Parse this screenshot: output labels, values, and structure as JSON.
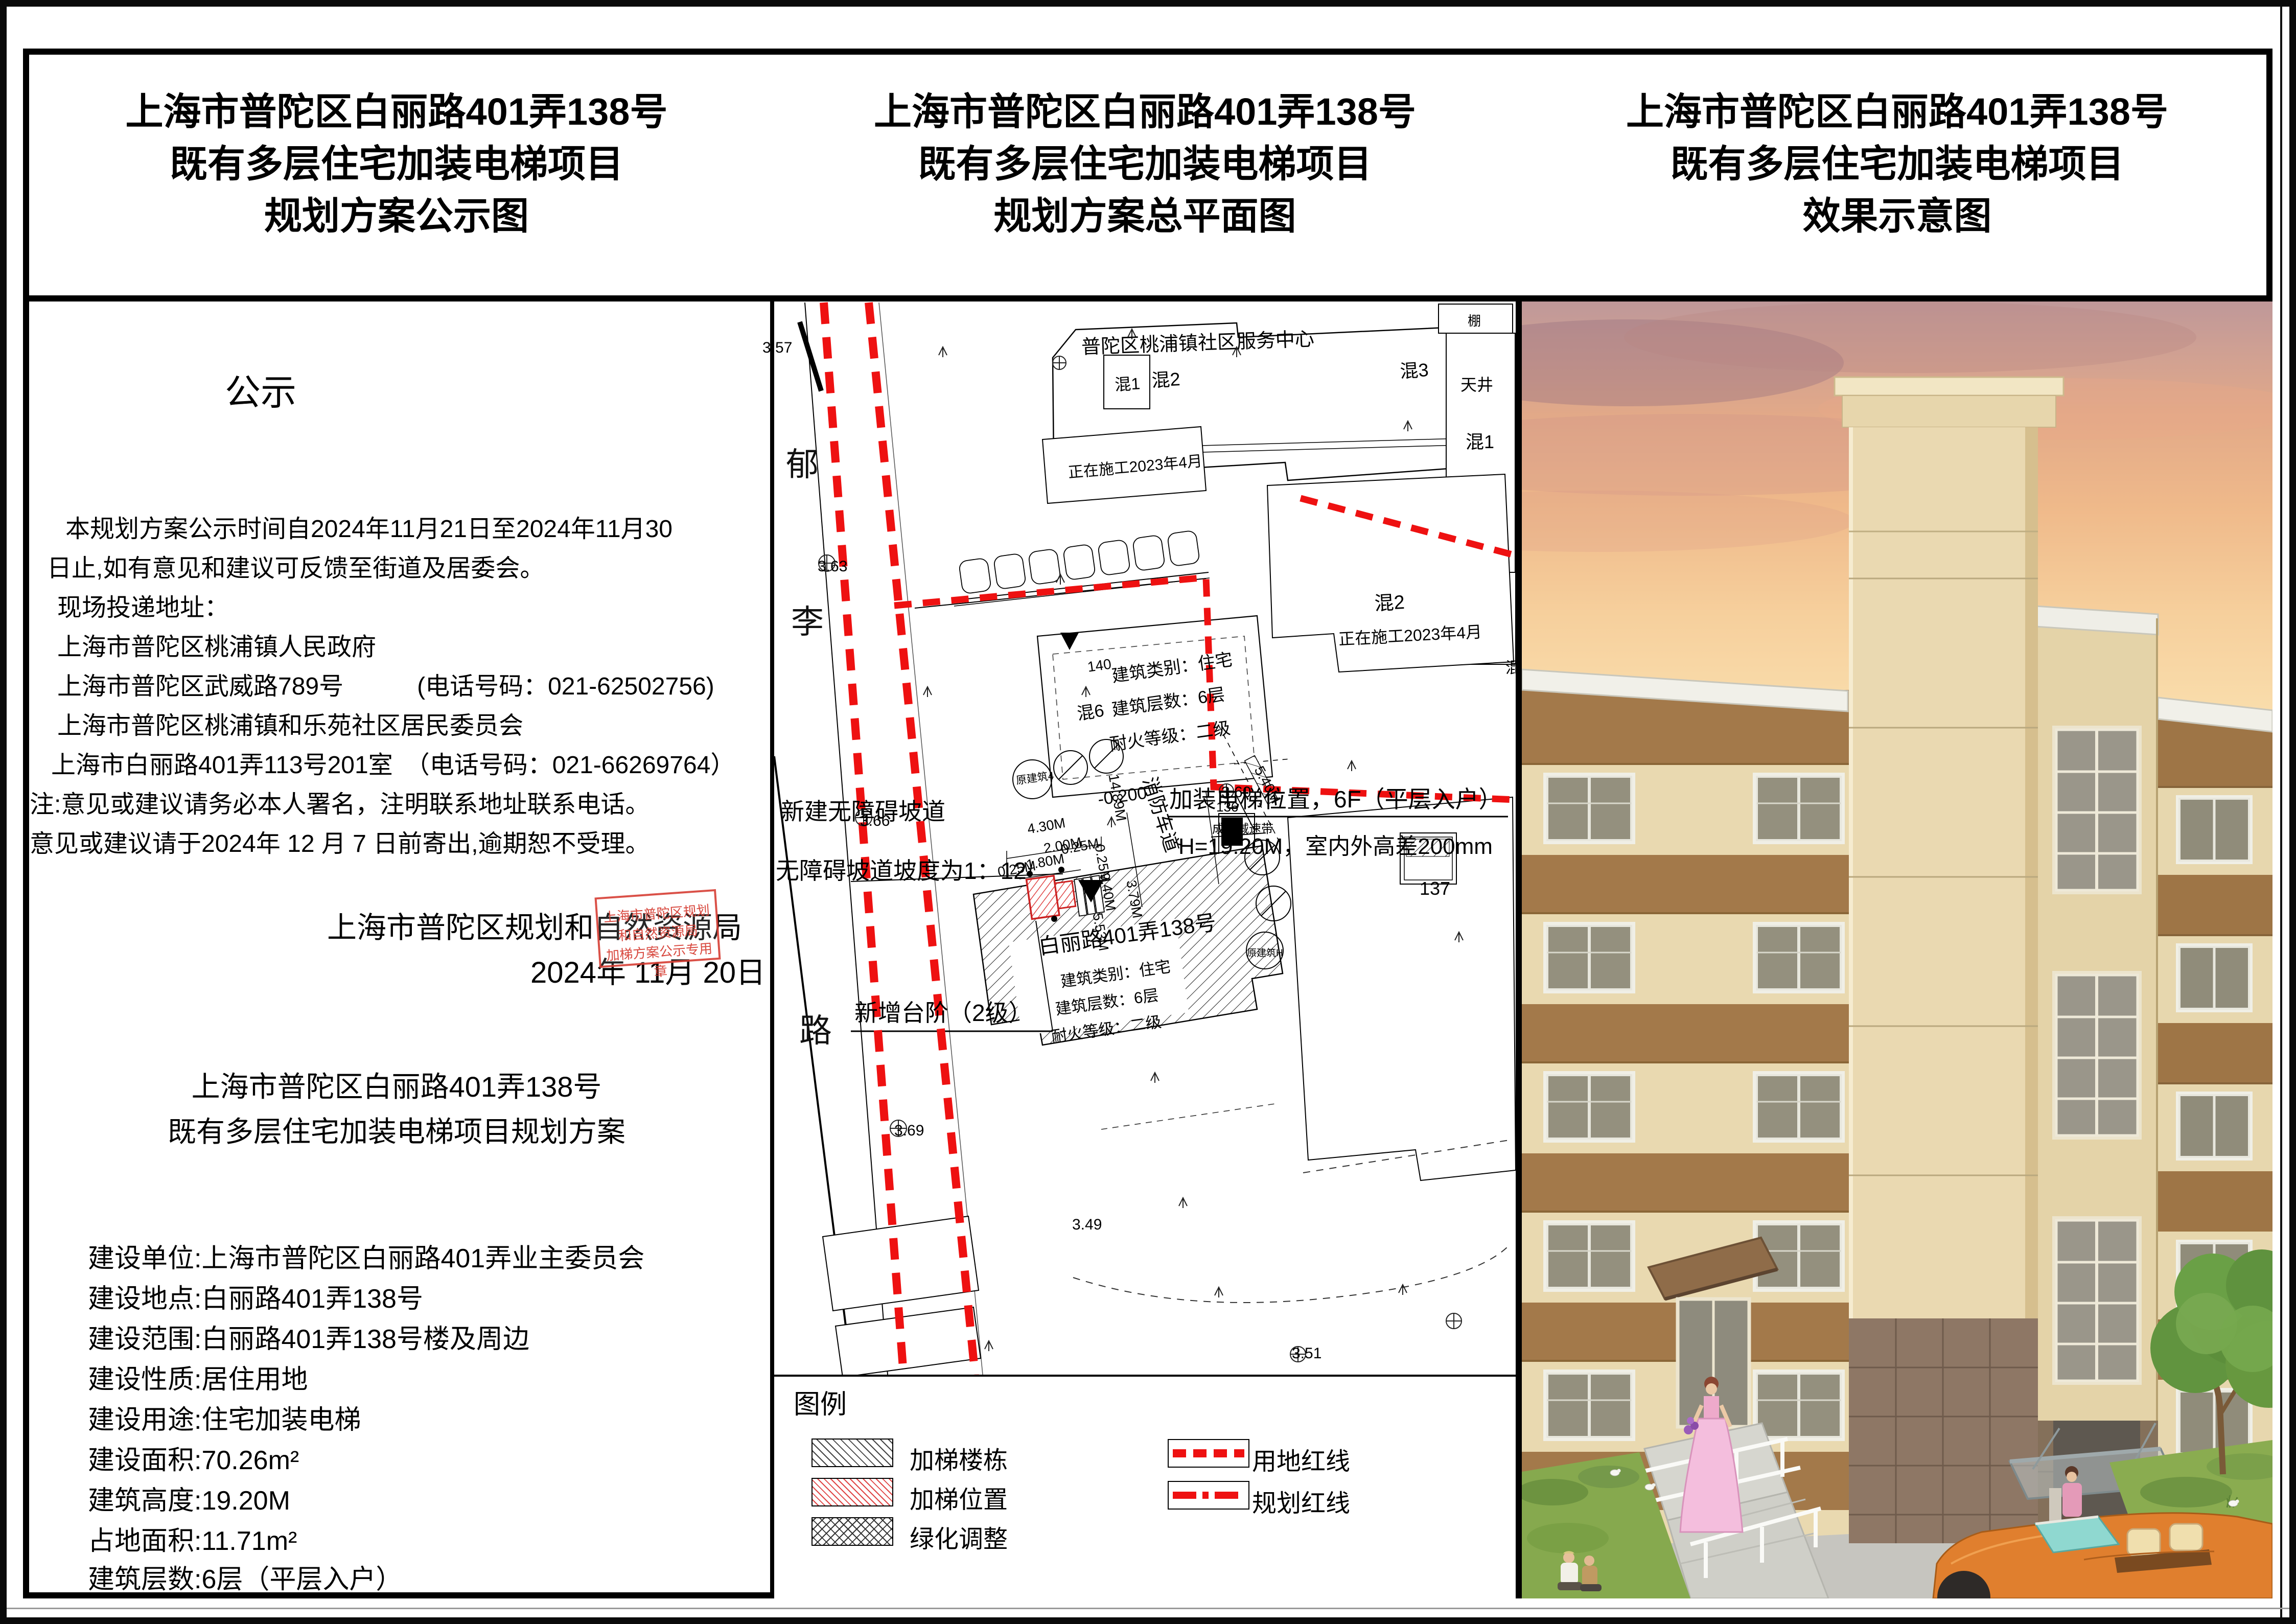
{
  "header": {
    "col1": [
      "上海市普陀区白丽路401弄138号",
      "既有多层住宅加装电梯项目",
      "规划方案公示图"
    ],
    "col2": [
      "上海市普陀区白丽路401弄138号",
      "既有多层住宅加装电梯项目",
      "规划方案总平面图"
    ],
    "col3": [
      "上海市普陀区白丽路401弄138号",
      "既有多层住宅加装电梯项目",
      "效果示意图"
    ]
  },
  "left_panel": {
    "section_title": "公示",
    "notice_lines": [
      "本规划方案公示时间自2024年11月21日至2024年11月30",
      "日止,如有意见和建议可反馈至街道及居委会。",
      "现场投递地址：",
      "上海市普陀区桃浦镇人民政府",
      "上海市普陀区武威路789号　　　(电话号码：021-62502756)",
      "上海市普陀区桃浦镇和乐苑社区居民委员会",
      "上海市白丽路401弄113号201室　（电话号码：021-66269764）",
      "注:意见或建议请务必本人署名，注明联系地址联系电话。",
      "意见或建议请于2024年 12 月 7 日前寄出,逾期恕不受理。"
    ],
    "authority": "上海市普陀区规划和自然资源局",
    "date": "2024年 11月 20日",
    "stamp_lines": [
      "上海市普陀区规划和自然资源局",
      "加梯方案公示专用章"
    ],
    "project_title_lines": [
      "上海市普陀区白丽路401弄138号",
      "既有多层住宅加装电梯项目规划方案"
    ],
    "details": [
      "建设单位:上海市普陀区白丽路401弄业主委员会",
      "建设地点:白丽路401弄138号",
      "建设范围:白丽路401弄138号楼及周边",
      "建设性质:居住用地",
      "建设用途:住宅加装电梯",
      "建设面积:70.26m²",
      "建筑高度:19.20M",
      "占地面积:11.71m²",
      "建筑层数:6层（平层入户）"
    ]
  },
  "map": {
    "labels": {
      "service_center": "普陀区桃浦镇社区服务中心",
      "hun1_a": "混1",
      "hun2_a": "混2",
      "hun3": "混3",
      "tianjing": "天井",
      "peng": "棚",
      "hun1_b": "混1",
      "constructing_a": "正在施工2023年4月",
      "hun2_b": "混2",
      "constructing_b": "正在施工2023年4月",
      "hun_cut": "混",
      "n140": "140",
      "b140_l1": "建筑类别：住宅",
      "hun6": "混6",
      "b140_l2": "建筑层数：6层",
      "b140_l3": "耐火等级：二级",
      "elev_pos": "加装电梯位置，6F（平层入户）",
      "elev_h": "H=19.20M，室内外高差200mm",
      "ramp1": "新建无障碍坡道",
      "ramp2": "无障碍坡道坡度为1：12",
      "steps": "新增台阶（2级）",
      "b138": "白丽路401弄138号",
      "b138_l1": "建筑类别：住宅",
      "b138_l2": "建筑层数：6层",
      "b138_l3": "耐火等级：二级",
      "fire_lane": "消防车道",
      "speed_bump": "成品减速带",
      "n137": "137",
      "n136": "136",
      "road_char1": "郁",
      "road_char2": "李",
      "road_char3": "路",
      "ref4": "原建筑4",
      "refH": "原建筑H"
    },
    "elevations": {
      "e357": "3.57",
      "e363": "3.63",
      "e366": "3.66",
      "e369": "3.69",
      "e360": "3.60",
      "e349": "3.49",
      "e351": "3.51",
      "e0200": "-0.200"
    },
    "dims": {
      "d430": "4.30M",
      "d200": "2.00M",
      "d180": "1.80M",
      "d025a": "0.25M",
      "d025b": "0.25M",
      "d025c": "0.25M",
      "d1489": "14.89M",
      "d940": "9.40M",
      "d379": "3.79M",
      "d553": "5.53M",
      "d540": "5.40M"
    },
    "legend": {
      "title": "图例",
      "items": [
        {
          "label": "加梯楼栋"
        },
        {
          "label": "加梯位置"
        },
        {
          "label": "绿化调整"
        },
        {
          "label": "用地红线"
        },
        {
          "label": "规划红线"
        }
      ]
    },
    "colors": {
      "red_line": "#ee1111",
      "elevator_hatch": "#e04545"
    }
  }
}
